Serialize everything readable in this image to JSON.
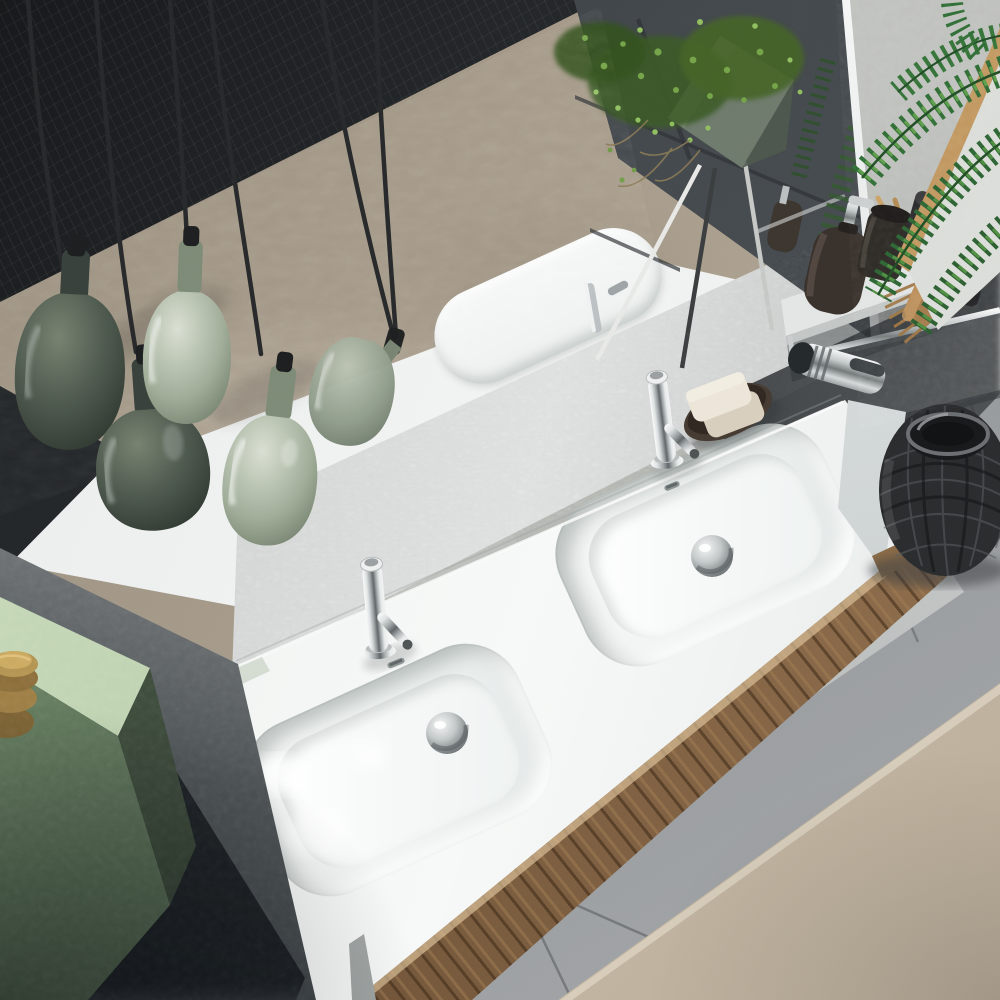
{
  "scene": {
    "label": "Top-down photograph of a modern bathroom double-sink vanity with green pendant lamps, mirror reflection, accessory shelf and grey tiled floor",
    "setting": "bathroom",
    "view": "overhead three-quarter",
    "objects": [
      {
        "name": "feature-wall-dark-leather-texture",
        "color_ref": "leather"
      },
      {
        "name": "mirror-reflection-taupe-rug-band",
        "color_ref": "taupe"
      },
      {
        "name": "mirror-reflection-slate-floor-tiles",
        "color_ref": "mirror_tile"
      },
      {
        "name": "mirror-reflection-plant-stand-with-trailing-plant",
        "color_ref": "plant"
      },
      {
        "name": "mirror-reflection-counter-and-faucet",
        "color_ref": "counter"
      },
      {
        "name": "crackled-silver-backsplash-band",
        "color_ref": "silver"
      },
      {
        "name": "white-double-washbasin-countertop",
        "color_ref": "counter"
      },
      {
        "name": "left-washbasin",
        "color_ref": "counter"
      },
      {
        "name": "right-washbasin",
        "color_ref": "counter"
      },
      {
        "name": "chrome-mixer-tap-left",
        "color_ref": "chrome"
      },
      {
        "name": "chrome-mixer-tap-right",
        "color_ref": "chrome"
      },
      {
        "name": "chrome-drain-left",
        "color_ref": "chrome"
      },
      {
        "name": "chrome-drain-right",
        "color_ref": "chrome"
      },
      {
        "name": "soap-bars-on-dark-tray",
        "color_ref": "soap"
      },
      {
        "name": "walnut-vanity-cabinet",
        "color_ref": "wood"
      },
      {
        "name": "sage-pendant-lamps-cluster-of-five",
        "color_ref": "sage"
      },
      {
        "name": "black-lamp-cords",
        "color_ref": "cord"
      },
      {
        "name": "green-wall-cabinet",
        "color_ref": "cabinet_front"
      },
      {
        "name": "brass-stacked-jars",
        "color_ref": "brass"
      },
      {
        "name": "white-wall-shelf-with-chrome-rail",
        "color_ref": "counter"
      },
      {
        "name": "dark-soap-dispenser-with-chrome-pump",
        "color_ref": "bottle"
      },
      {
        "name": "black-tumbler-with-wooden-toothbrushes",
        "color_ref": "black_item"
      },
      {
        "name": "black-canisters-with-white-ring-logo",
        "color_ref": "black_item"
      },
      {
        "name": "wooden-hand-brush",
        "color_ref": "wood_acc"
      },
      {
        "name": "chrome-accessory-holder",
        "color_ref": "chrome"
      },
      {
        "name": "framed-palm-leaf-print",
        "color_ref": "palm"
      },
      {
        "name": "palm-fronds",
        "color_ref": "palm"
      },
      {
        "name": "black-rattan-lantern",
        "color_ref": "lantern"
      },
      {
        "name": "grey-porcelain-floor-tiles",
        "color_ref": "floor"
      },
      {
        "name": "beige-area-rug",
        "color_ref": "rug"
      },
      {
        "name": "textured-stucco-wall",
        "color_ref": "wall"
      },
      {
        "name": "leaning-white-panel",
        "color_ref": "counter"
      }
    ]
  },
  "palette": {
    "wall": "#b6b8b4",
    "leather": "#26292c",
    "taupe": "#a79c8b",
    "mirror_tile": "#42474b",
    "silver": "#d7dad9",
    "counter": "#f1f3f2",
    "wood": "#7b5c3e",
    "floor": "#8f9295",
    "grout": "#6e7275",
    "rug": "#c9bdaa",
    "cabinet_top": "#c3d6b6",
    "cabinet_front": "#74906c",
    "sage": "#9fac97",
    "sage_light": "#d9dfd2",
    "sage_deep": "#606d5a",
    "olive": "#454f44",
    "olive_deep": "#232a23",
    "chrome": "#c9cdcd",
    "cord": "#26282a",
    "black_item": "#2a292b",
    "bottle": "#38302b",
    "soap": "#e9e2d4",
    "wood_acc": "#a3794a",
    "brass": "#b2924f",
    "plant": "#4f7c36",
    "palm": "#2e6b33",
    "lantern": "#292b2d"
  }
}
